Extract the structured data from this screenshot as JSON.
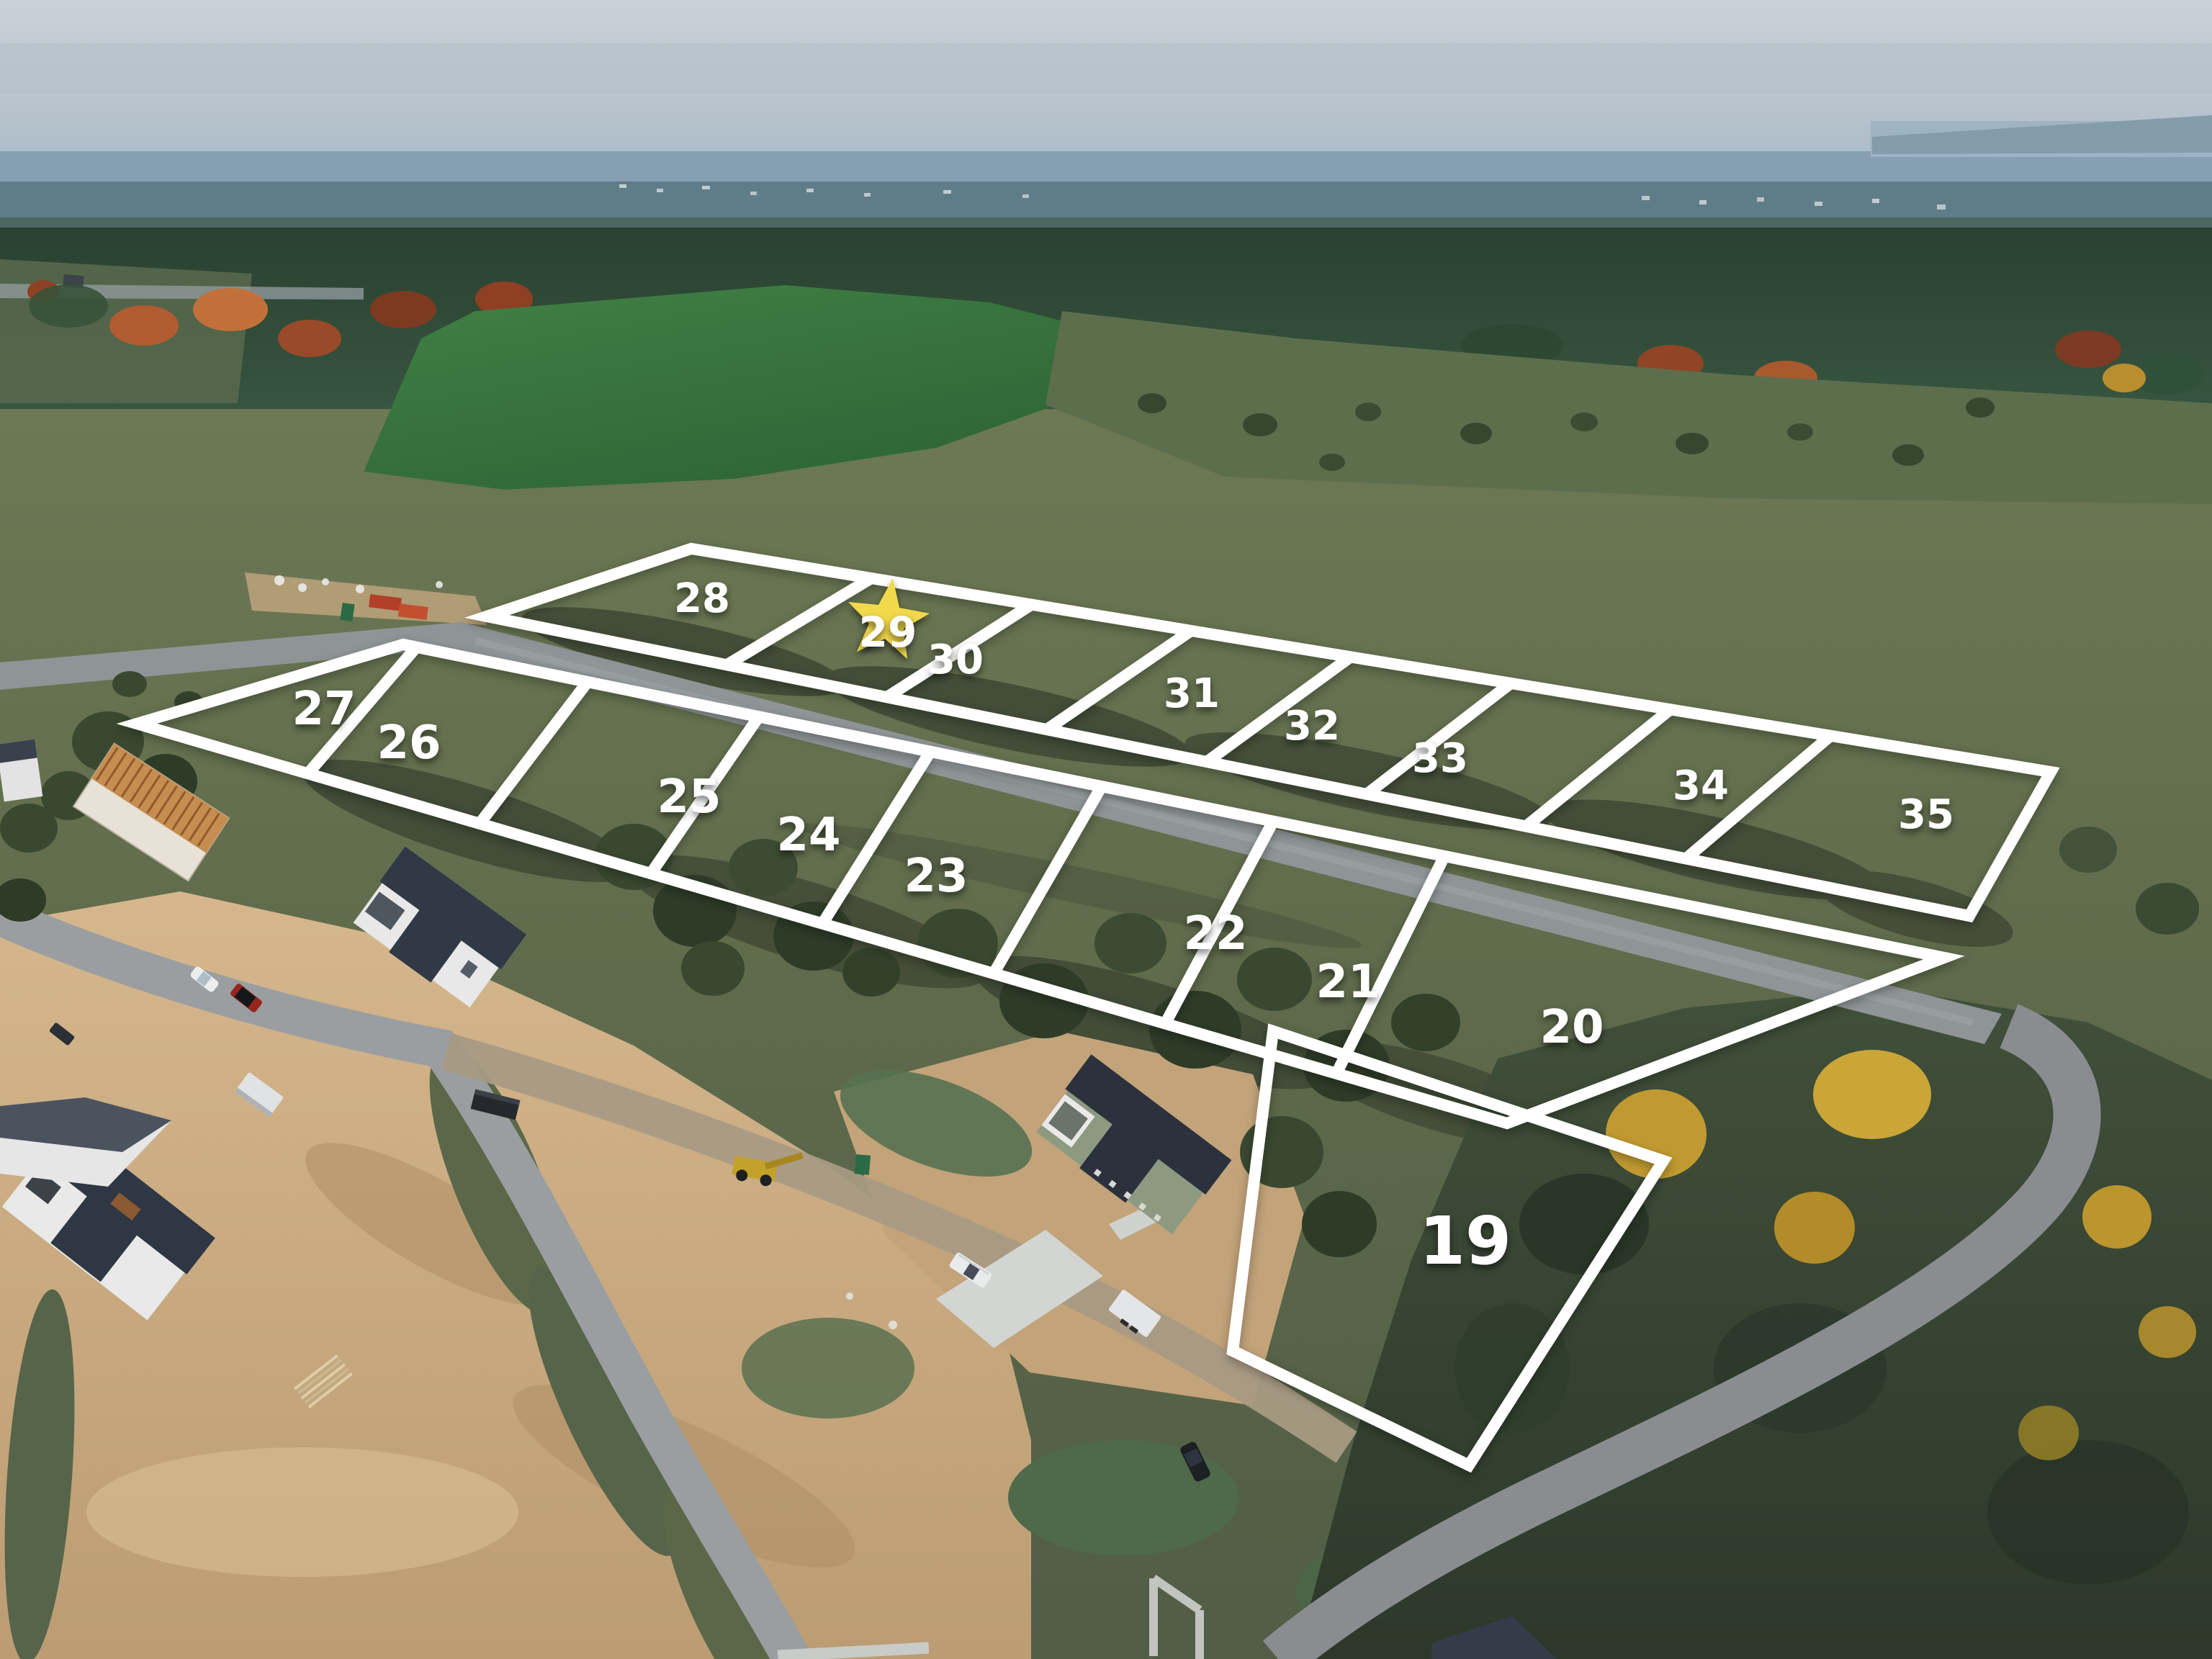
{
  "annotation": {
    "line_color": "#ffffff",
    "label_color": "#ffffff",
    "star_color": "#f2d94b",
    "highlighted_lot": "29"
  },
  "lots": {
    "back_row": [
      {
        "number": "28"
      },
      {
        "number": "29",
        "highlighted": true
      },
      {
        "number": "30"
      },
      {
        "number": "31"
      },
      {
        "number": "32"
      },
      {
        "number": "33"
      },
      {
        "number": "34"
      },
      {
        "number": "35"
      }
    ],
    "front_row": [
      {
        "number": "27"
      },
      {
        "number": "26"
      },
      {
        "number": "25"
      },
      {
        "number": "24"
      },
      {
        "number": "23"
      },
      {
        "number": "22"
      },
      {
        "number": "21"
      },
      {
        "number": "20"
      }
    ],
    "corner_lot": {
      "number": "19"
    }
  }
}
